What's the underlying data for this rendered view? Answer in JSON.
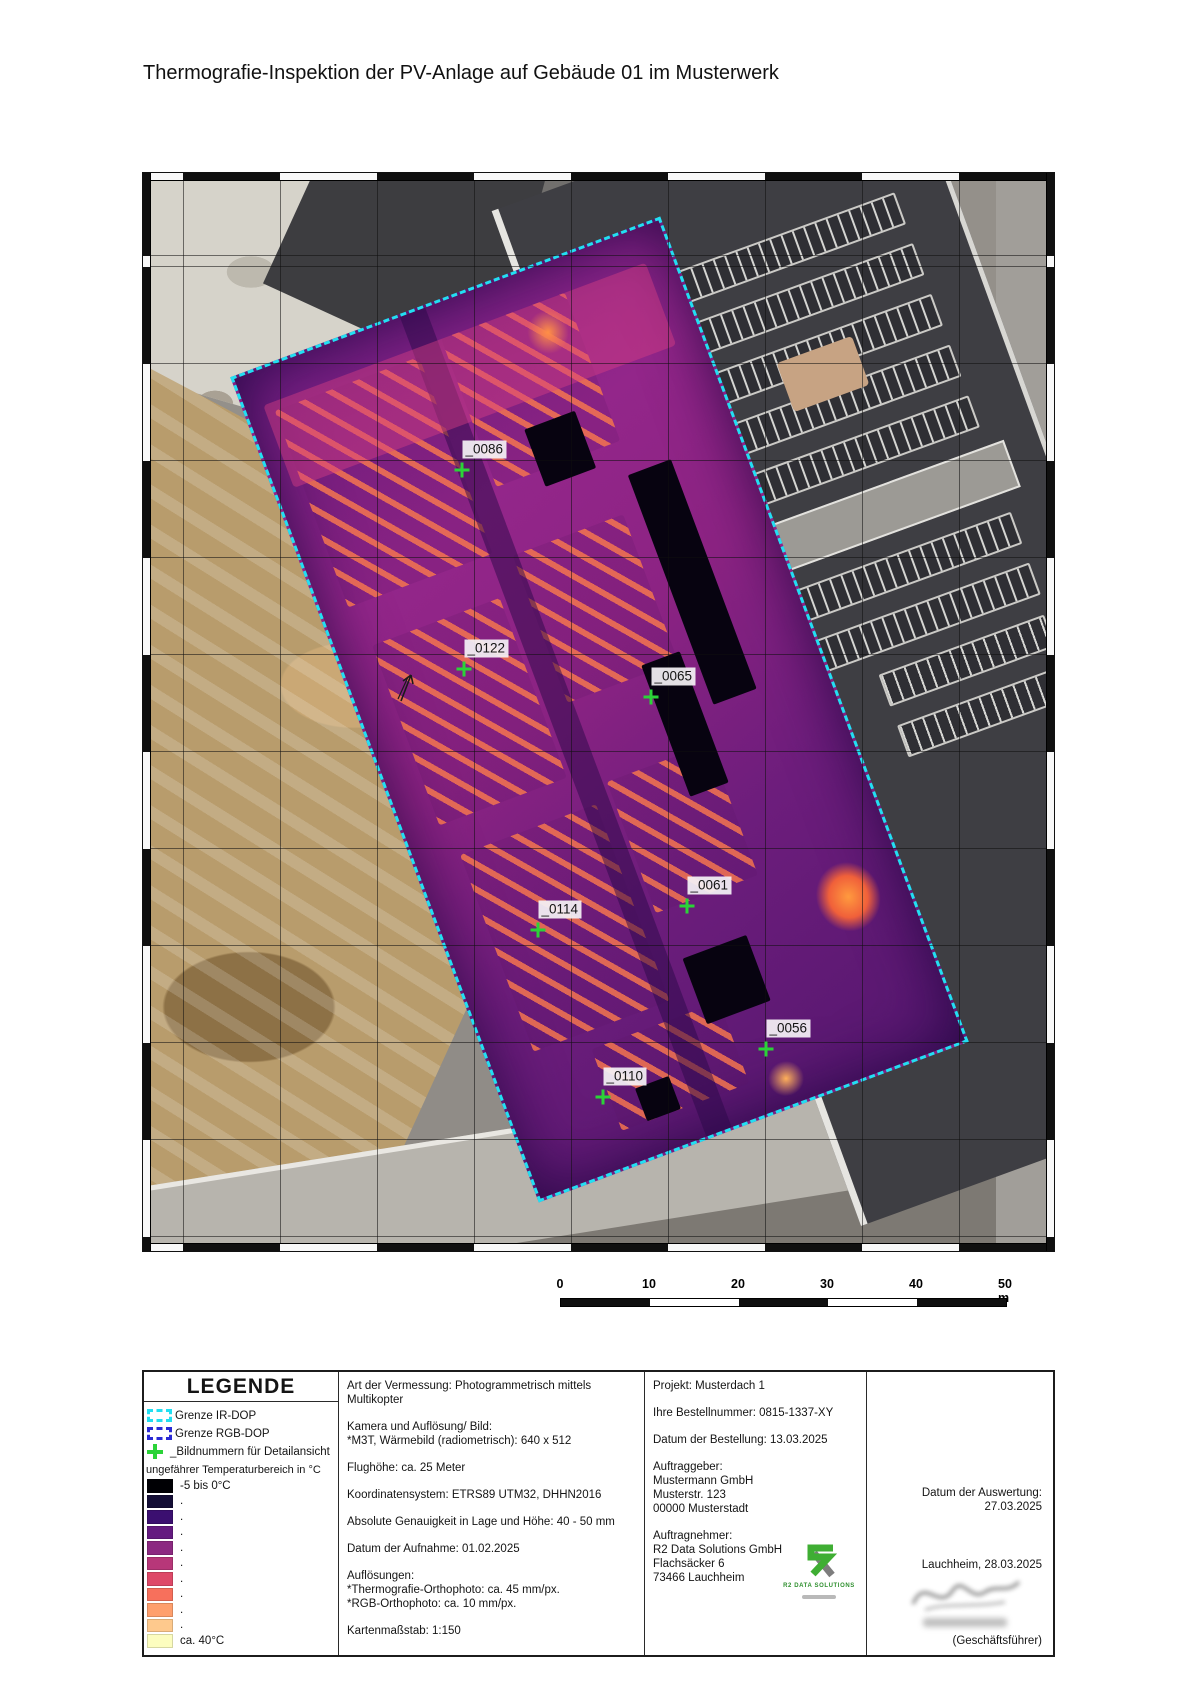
{
  "title": "Thermografie-Inspektion der PV-Anlage auf Gebäude 01 im Musterwerk",
  "map": {
    "markers": [
      {
        "label": "_0086",
        "x": 319,
        "y": 297
      },
      {
        "label": "_0122",
        "x": 321,
        "y": 496
      },
      {
        "label": "_0065",
        "x": 508,
        "y": 524
      },
      {
        "label": "_0061",
        "x": 544,
        "y": 733
      },
      {
        "label": "_0114",
        "x": 395,
        "y": 757
      },
      {
        "label": "_0056",
        "x": 623,
        "y": 876
      },
      {
        "label": "_0110",
        "x": 460,
        "y": 924
      }
    ],
    "boundary_color": "#22dff2"
  },
  "scalebar": {
    "labels": [
      {
        "text": "0",
        "x": 0
      },
      {
        "text": "10",
        "x": 89
      },
      {
        "text": "20",
        "x": 178
      },
      {
        "text": "30",
        "x": 267
      },
      {
        "text": "40",
        "x": 356
      },
      {
        "text": "50 m",
        "x": 452
      }
    ],
    "segments": [
      {
        "color": "#101010"
      },
      {
        "color": "#ffffff"
      },
      {
        "color": "#101010"
      },
      {
        "color": "#ffffff"
      },
      {
        "color": "#101010"
      }
    ]
  },
  "legend": {
    "header": "LEGENDE",
    "boundary_items": [
      {
        "label": "Grenze IR-DOP",
        "color": "#22dff2"
      },
      {
        "label": "Grenze RGB-DOP",
        "color": "#2a2ad4"
      }
    ],
    "marker_item_label": "_Bildnummern für Detailansicht",
    "temp_title": "ungefährer Temperaturbereich in °C",
    "swatches": [
      {
        "color": "#000004",
        "label": "-5 bis 0°C"
      },
      {
        "color": "#140e36",
        "label": "."
      },
      {
        "color": "#3b0f70",
        "label": "."
      },
      {
        "color": "#641a80",
        "label": "."
      },
      {
        "color": "#8c2981",
        "label": "."
      },
      {
        "color": "#b73779",
        "label": "."
      },
      {
        "color": "#de4968",
        "label": "."
      },
      {
        "color": "#f7705c",
        "label": "."
      },
      {
        "color": "#fe9f6d",
        "label": "."
      },
      {
        "color": "#fec98d",
        "label": "."
      },
      {
        "color": "#fcfdbf",
        "label": "ca. 40°C"
      }
    ]
  },
  "survey": {
    "paragraphs": [
      [
        "Art der Vermessung: Photogrammetrisch mittels Multikopter"
      ],
      [
        "Kamera und Auflösung/ Bild:",
        "*M3T, Wärmebild (radiometrisch): 640 x 512"
      ],
      [
        "Flughöhe: ca. 25 Meter"
      ],
      [
        "Koordinatensystem: ETRS89 UTM32, DHHN2016"
      ],
      [
        "Absolute Genauigkeit in Lage und Höhe: 40 - 50 mm"
      ],
      [
        "Datum der Aufnahme: 01.02.2025"
      ],
      [
        "Auflösungen:",
        "*Thermografie-Orthophoto: ca. 45 mm/px.",
        "*RGB-Orthophoto: ca. 10 mm/px."
      ],
      [
        "Kartenmaßstab: 1:150"
      ]
    ]
  },
  "project": {
    "blocks": [
      [
        "Projekt: Musterdach 1"
      ],
      [
        "Ihre Bestellnummer: 0815-1337-XY"
      ],
      [
        "Datum der Bestellung: 13.03.2025"
      ],
      [
        "Auftraggeber:",
        "Mustermann GmbH",
        "Musterstr. 123",
        "00000 Musterstadt"
      ],
      [
        "Auftragnehmer:",
        "R2 Data Solutions GmbH",
        "Flachsäcker 6",
        "73466 Lauchheim"
      ]
    ],
    "logo_brand": "R2 DATA SOLUTIONS"
  },
  "evaluation": {
    "date_label": "Datum der Auswertung:",
    "date": "27.03.2025",
    "place_date": "Lauchheim, 28.03.2025",
    "signature_caption": "(Geschäftsführer)"
  }
}
